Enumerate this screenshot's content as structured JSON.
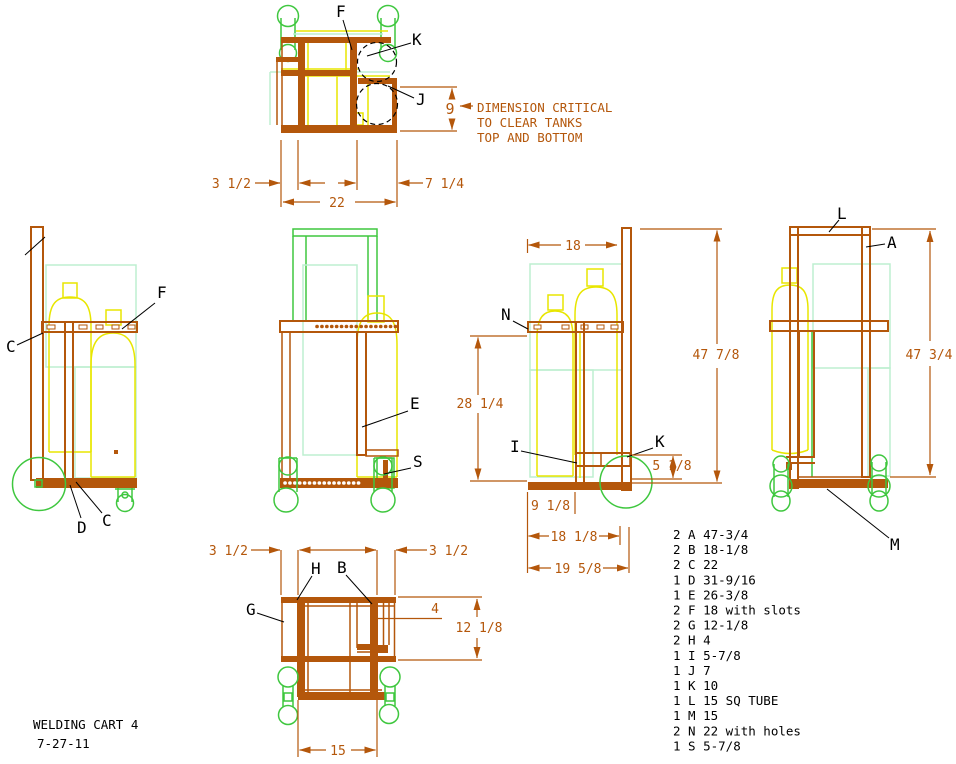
{
  "title": {
    "line1": "WELDING CART 4",
    "line2": "7-27-11"
  },
  "note": {
    "line1": "DIMENSION CRITICAL",
    "line2": "TO CLEAR TANKS",
    "line3": "TOP AND BOTTOM"
  },
  "colors": {
    "frame": "#B4570B",
    "dimension": "#B4570B",
    "tank": "#E8E600",
    "caster": "#3FC73F",
    "ghost": "#BDEFD0",
    "label": "#000000",
    "background": "#FFFFFF"
  },
  "views": {
    "top": {
      "labels": {
        "f": "F",
        "k": "K",
        "j": "J"
      },
      "dims": {
        "left": "3 1/2",
        "width": "22",
        "right": "7 1/4",
        "clearance": "9"
      }
    },
    "left": {
      "labels": {
        "c_top": "C",
        "f": "F",
        "d": "D",
        "c_bottom": "C"
      }
    },
    "front": {
      "labels": {
        "e": "E",
        "s": "S"
      }
    },
    "right": {
      "labels": {
        "n": "N",
        "i": "I",
        "k": "K"
      },
      "dims": {
        "top_width": "18",
        "height": "47 7/8",
        "mid_height": "28 1/4",
        "small": "5 1/8",
        "base1": "9 1/8",
        "base2": "18 1/8",
        "base3": "19 5/8"
      }
    },
    "far_right": {
      "labels": {
        "l": "L",
        "a": "A",
        "m": "M"
      },
      "dims": {
        "height": "47 3/4"
      }
    },
    "bottom": {
      "labels": {
        "h": "H",
        "b": "B",
        "g": "G"
      },
      "dims": {
        "left": "3 1/2",
        "right": "3 1/2",
        "pocket": "4",
        "depth": "12 1/8",
        "width": "15"
      }
    }
  },
  "parts": [
    "2 A 47-3/4",
    "2 B 18-1/8",
    "2 C 22",
    "1 D 31-9/16",
    "1 E 26-3/8",
    "2 F 18 with slots",
    "2 G 12-1/8",
    "2 H 4",
    "1 I 5-7/8",
    "1 J 7",
    "1 K 10",
    "1 L 15 SQ TUBE",
    "1 M 15",
    "2 N 22 with holes",
    "1 S 5-7/8"
  ]
}
